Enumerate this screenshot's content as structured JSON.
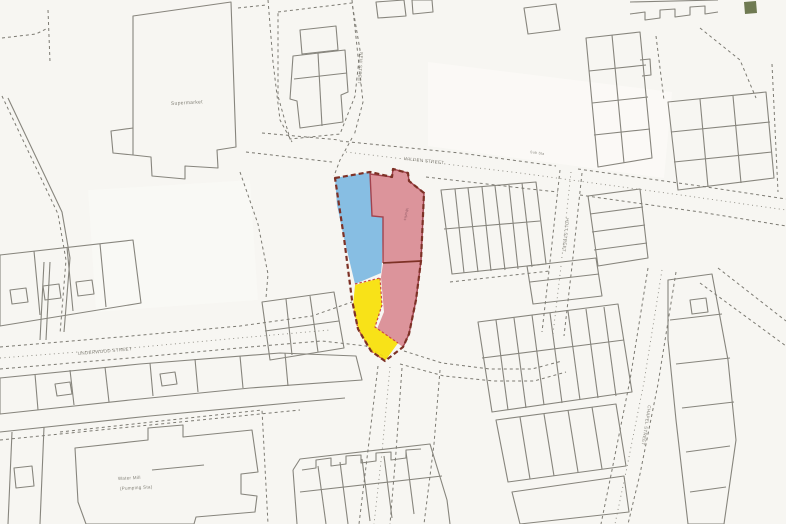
{
  "page": {
    "kind": "scanned site location plan",
    "width": 786,
    "height": 524
  },
  "colors": {
    "paper": "#f7f6f2",
    "paper_bright": "#fcfbf8",
    "line": "#87857d",
    "line_dark": "#6e6c64",
    "dash": "#7c7a72",
    "dot": "#8a887f",
    "label": "#6e6c62",
    "site_boundary": "#7d3126",
    "parcel_blue": "#7db9e2",
    "parcel_red": "#d98b94",
    "parcel_red_line": "#a2434e",
    "parcel_yellow": "#f7e005",
    "yellow_edge": "#cc4a44",
    "green_block": "#6f7a52"
  },
  "site": {
    "outline": "M335,178 L370,172 L392,177 L393,169 L408,173 L409,181 L424,193 L421,261 L416,300 L409,334 L403,347 L385,361 L371,351 L358,329 L352,300 L344,238 Z",
    "parcels": [
      {
        "name": "parcel-blue",
        "color_key": "parcel_blue",
        "d": "M335,178 L370,172 L372,216 L383,217 L382,262 L381,273 L355,284 L344,238 L337,205 Z"
      },
      {
        "name": "parcel-red-north",
        "color_key": "parcel_red",
        "d": "M370,174 L392,177 L393,169 L408,173 L409,181 L424,193 L421,261 L383,263 L383,217 L372,216 Z"
      },
      {
        "name": "parcel-red-south",
        "color_key": "parcel_red",
        "d": "M383,264 L421,261 L416,300 L409,334 L403,347 L377,329 L384,312 L381,277 Z"
      },
      {
        "name": "parcel-yellow",
        "color_key": "parcel_yellow",
        "d": "M355,285 L380,278 L382,305 L375,327 L398,343 L385,361 L371,351 L358,329 L353,306 Z"
      }
    ],
    "internal_lines": [
      {
        "d": "M370,173 L372,216 L383,217 L383,263",
        "stroke": "parcel_red_line",
        "w": 1.4,
        "dash": ""
      },
      {
        "d": "M370,174 L392,177 L393,169 L408,173 L409,181 L424,193 L421,261 L416,300 L409,334 L403,347",
        "stroke": "parcel_red_line",
        "w": 1.4,
        "dash": ""
      },
      {
        "d": "M383,263 L421,261",
        "stroke": "site_boundary",
        "w": 1.8,
        "dash": ""
      },
      {
        "d": "M355,284 L380,278",
        "stroke": "yellow_edge",
        "w": 1.2,
        "dash": "2.5 2"
      },
      {
        "d": "M380,278 L382,305 L375,327 L398,343",
        "stroke": "yellow_edge",
        "w": 1.2,
        "dash": "2.5 2"
      },
      {
        "d": "M353,306 L358,329 L371,351 L385,361",
        "stroke": "yellow_edge",
        "w": 1.2,
        "dash": "2.5 2"
      }
    ]
  },
  "labels": [
    {
      "name": "label-supermarket",
      "text": "Supermarket",
      "x": 171,
      "y": 105,
      "size": 5,
      "rotate": -3
    },
    {
      "name": "label-wilden-street",
      "text": "WILDEN STREET",
      "x": 404,
      "y": 160,
      "size": 4.5,
      "rotate": 6
    },
    {
      "name": "label-underwood-street",
      "text": "UNDERWOOD STREET",
      "x": 78,
      "y": 355,
      "size": 4.5,
      "rotate": -5
    },
    {
      "name": "label-water-mill",
      "text": "Water Mill",
      "x": 118,
      "y": 480,
      "size": 4.5,
      "rotate": -3
    },
    {
      "name": "label-pumping-sta",
      "text": "(Pumping Sta)",
      "x": 120,
      "y": 490,
      "size": 4.5,
      "rotate": -3
    },
    {
      "name": "label-holt-street",
      "text": "HOLT STREET",
      "x": 566,
      "y": 218,
      "size": 4.5,
      "rotate": 96
    },
    {
      "name": "label-chapel-street",
      "text": "CHAPEL STREET",
      "x": 648,
      "y": 405,
      "size": 4.5,
      "rotate": 99
    },
    {
      "name": "label-new-street",
      "text": "NEW STREET",
      "x": 360,
      "y": 52,
      "size": 4.5,
      "rotate": 94
    },
    {
      "name": "label-works",
      "text": "Works",
      "x": 406,
      "y": 208,
      "size": 4,
      "rotate": 100,
      "color": "#8a5560"
    },
    {
      "name": "label-sub-sta",
      "text": "Sub Sta",
      "x": 530,
      "y": 153,
      "size": 3.5,
      "rotate": 8
    }
  ],
  "map": {
    "tints": [
      {
        "name": "bright-patch-right-of-site",
        "d": "M428,62 L672,92 L664,178 L428,146 Z",
        "opacity": 0.7
      },
      {
        "name": "bright-patch-center-left",
        "d": "M88,190 L250,180 L258,300 L96,312 Z",
        "opacity": 0.5
      }
    ],
    "green_block": "M744,2 L756,1 L757,13 L745,14 Z",
    "solid": [
      "M133,16 L231,2 L236,147 L217,150 L218,168 L185,166 L185,179 L152,176 L151,157 L133,155 Z",
      "M133,128 L111,131 L113,153 L133,155",
      "M8,98 L62,212 L70,258 L64,332",
      "M0,255 L133,240 L141,303 L0,326 Z",
      "M34,251 L40,315",
      "M67,247 L73,311",
      "M100,244 L106,307",
      "M10,290 L26,288 L28,302 L12,304 Z",
      "M43,286 L59,284 L61,298 L45,300 Z",
      "M76,282 L92,280 L94,294 L78,296 Z",
      "M44,262 L40,340",
      "M50,262 L46,340",
      "M293,56 L345,50 L348,92 L341,95 L343,122 L300,128 L297,101 L290,99 Z",
      "M294,79 L347,73",
      "M318,53 L322,126",
      "M300,30 L336,26 L338,50 L302,54 Z",
      "M376,2 L404,0 L406,16 L378,18 Z",
      "M412,0 L432,0 L433,12 L413,14 Z",
      "M441,190 L536,182 L546,264 L452,274 Z",
      "M455,189 L464,273",
      "M468,188 L478,272",
      "M482,187 L491,271",
      "M495,186 L505,270",
      "M509,185 L518,269",
      "M522,183 L532,267",
      "M444,229 L540,221",
      "M586,38 L640,32 L652,158 L598,167 Z",
      "M589,71 L646,65",
      "M592,103 L648,97",
      "M594,135 L650,129",
      "M612,35 L624,163",
      "M640,60 L650,59 L651,75 L642,76",
      "M668,102 L766,92 L774,178 L678,190 Z",
      "M700,99 L708,187",
      "M733,96 L741,183",
      "M671,132 L770,122",
      "M674,162 L772,152",
      "M630,14 L645,12 L645,20 L660,18 L660,10 L675,9 L675,17 L690,15 L690,7 L705,6 L705,14 L718,12",
      "M630,2 L718,0",
      "M524,8 L556,4 L560,30 L528,34 Z",
      "M262,302 L334,292 L344,348 L270,360 Z",
      "M286,299 L292,355",
      "M310,296 L318,352",
      "M265,331 L339,321",
      "M0,378 L140,364 L280,353 L356,356 L362,380 L250,388 L130,400 L0,414 Z",
      "M35,374 L38,410",
      "M70,370 L74,405",
      "M105,367 L109,402",
      "M150,363 L153,396",
      "M195,359 L198,392",
      "M240,356 L243,388",
      "M285,353 L288,386",
      "M55,384 L70,382 L72,394 L57,396 Z",
      "M160,374 L175,372 L177,384 L162,386 Z",
      "M0,432 L150,416 L300,402 L345,398",
      "M75,448 L148,440 L148,428 L183,425 L183,437 L252,430 L258,472 L241,474 L241,494 L257,496 L255,512 L196,517 L194,524 L86,524 L78,502 Z",
      "M152,470 L204,465",
      "M293,470 L300,459 L430,444 L447,500 L450,524",
      "M293,470 L297,524",
      "M302,470 L316,468 L316,460 L331,458 L331,466 L346,464 L346,456 L361,455 L361,463 L376,461 L376,453 L391,452 L391,460 L406,458 L406,450 L421,449",
      "M300,492 L442,476",
      "M318,466 L326,524",
      "M340,462 L348,524",
      "M362,459 L370,521",
      "M384,456 L392,518",
      "M406,452 L414,514",
      "M478,322 L618,304 L632,392 L492,412 Z",
      "M496,320 L508,410",
      "M514,318 L526,408",
      "M532,315 L544,405",
      "M550,313 L562,403",
      "M568,311 L580,400",
      "M586,309 L598,398",
      "M604,307 L616,396",
      "M482,358 L624,340",
      "M496,420 L616,404 L626,466 L508,482 Z",
      "M520,417 L530,479",
      "M544,414 L554,476",
      "M568,410 L578,472",
      "M592,407 L602,469",
      "M512,492 L624,476 L629,512 L520,524 Z",
      "M527,266 L596,258 L602,296 L533,304 Z",
      "M530,282 L599,274",
      "M668,280 L712,274 L728,360 L736,440 L724,524 L688,524 L676,420 L668,340 Z",
      "M670,320 L722,314",
      "M676,364 L730,358",
      "M682,408 L734,402",
      "M686,452 L730,446",
      "M690,492 L726,487",
      "M690,300 L706,298 L708,312 L692,314 Z",
      "M588,196 L640,189 L648,258 L598,266 Z",
      "M590,214 L643,207",
      "M592,232 L645,225",
      "M594,250 L647,243",
      "M12,432 L8,524",
      "M44,427 L40,524",
      "M14,468 L32,466 L34,486 L16,488 Z"
    ],
    "dashed": [
      "M2,38 L36,34 L48,28",
      "M48,10 L50,62",
      "M2,96 L58,214 L66,260 L60,334",
      "M278,12 L352,3 L360,50 L355,96 L340,134 L290,139 L278,96 Z",
      "M268,0 L273,62 L280,120 L292,142",
      "M352,0 L358,56 L363,102 L354,136",
      "M352,138 L340,160 L334,176",
      "M340,141 L460,153 L556,166",
      "M578,169 L700,186 L786,199",
      "M246,152 L332,162",
      "M426,177 L530,189 L558,192",
      "M580,195 L700,212 L786,226",
      "M560,170 L550,262 L542,332",
      "M582,173 L572,266 L564,336",
      "M404,351 L442,363 L490,369 L532,369 L562,361",
      "M400,364 L444,376 L494,381 L534,381 L566,372",
      "M378,366 L368,450 L359,524",
      "M402,368 L396,452 L390,524",
      "M440,370 L434,444 L424,524",
      "M0,347 L120,337 L240,326 L312,316 L352,302",
      "M0,369 L130,358 L250,347 L322,341 L366,346 L390,360",
      "M0,440 L160,424 L300,410",
      "M60,432 L262,410 L268,524",
      "M648,268 L630,380 L612,470 L601,524",
      "M676,272 L658,384 L640,474 L628,524",
      "M700,283 L786,346",
      "M718,268 L786,321",
      "M700,28 L740,60 L756,98",
      "M772,64 L778,192",
      "M240,172 L258,224 L268,274 L266,298",
      "M450,282 L550,271",
      "M262,133 L340,140",
      "M656,36 L664,100",
      "M238,8 L266,5"
    ],
    "dotted": [
      "M0,358 L130,348 L250,337 L330,330",
      "M346,152 L520,173 L688,196 L786,210",
      "M571,172 L561,266 L553,334",
      "M662,270 L644,382 L626,472 L615,524",
      "M390,367 L382,452 L374,524"
    ]
  }
}
